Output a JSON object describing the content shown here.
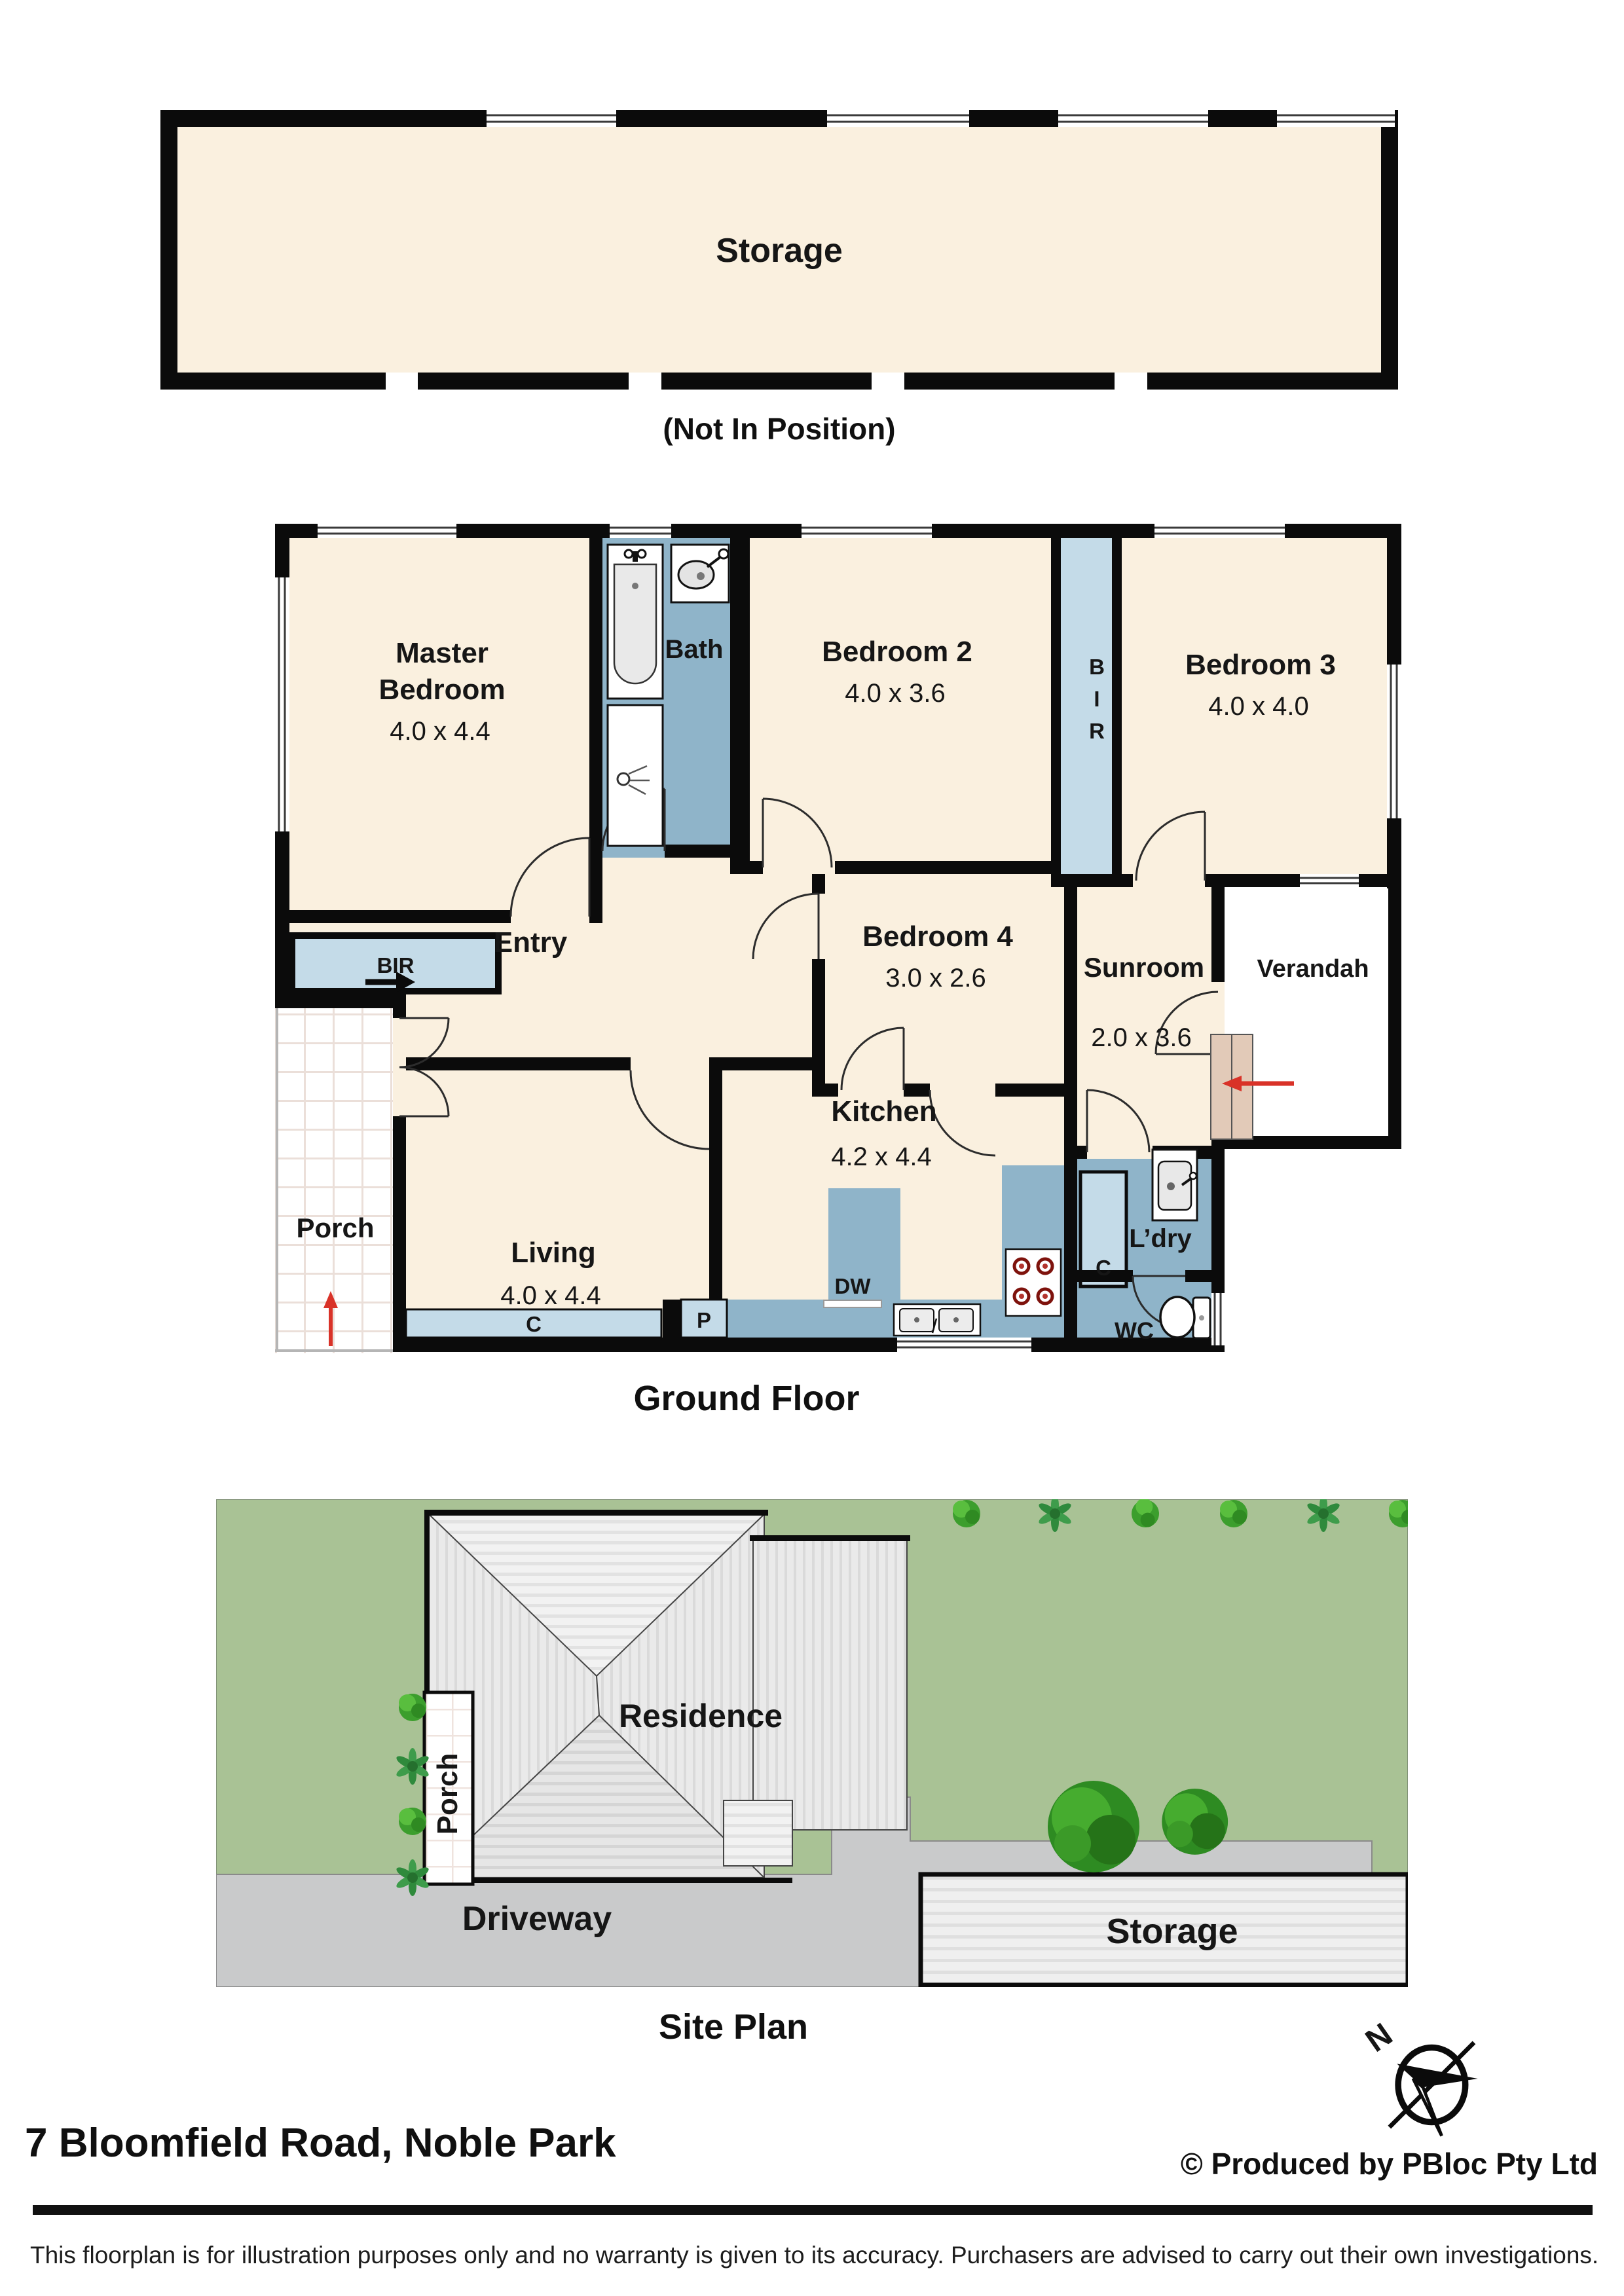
{
  "storage_upper": {
    "label": "Storage",
    "note": "(Not In Position)"
  },
  "ground_floor": {
    "title": "Ground Floor",
    "rooms": {
      "master": {
        "line1": "Master",
        "line2": "Bedroom",
        "dims": "4.0 x 4.4"
      },
      "bath": {
        "name": "Bath"
      },
      "bedroom2": {
        "name": "Bedroom 2",
        "dims": "4.0 x 3.6"
      },
      "bedroom3": {
        "name": "Bedroom 3",
        "dims": "4.0 x 4.0"
      },
      "bedroom4": {
        "name": "Bedroom 4",
        "dims": "3.0 x 2.6"
      },
      "entry": {
        "name": "Entry"
      },
      "sunroom": {
        "name": "Sunroom",
        "dims": "2.0 x 3.6"
      },
      "verandah": {
        "name": "Verandah"
      },
      "porch": {
        "name": "Porch"
      },
      "kitchen": {
        "name": "Kitchen",
        "dims": "4.2 x 4.4"
      },
      "living": {
        "name": "Living",
        "dims": "4.0 x 4.4"
      },
      "laundry": {
        "name": "L’dry"
      },
      "wc": {
        "name": "WC"
      }
    },
    "closets": {
      "bir_master": "BIR",
      "bir_hall": "BIR",
      "cupboard_living": "C",
      "pantry": "P",
      "dishwasher": "DW",
      "cupboard_laundry": "C"
    }
  },
  "site_plan": {
    "title": "Site Plan",
    "residence": "Residence",
    "porch": "Porch",
    "driveway": "Driveway",
    "storage": "Storage"
  },
  "footer": {
    "address": "7 Bloomfield Road, Noble Park",
    "credit": "© Produced by PBloc Pty Ltd",
    "compass_north": "N"
  },
  "disclaimer": "This floorplan is for illustration purposes only and no warranty is given to its accuracy. Purchasers are advised to carry out their own investigations.",
  "colors": {
    "room_cream": "#FAF0DF",
    "wet_blue": "#8FB4C9",
    "closet_blue": "#C4DBE8",
    "wall": "#0B0B0B",
    "grass": "#A9C295",
    "driveway": "#C9CACB",
    "roof": "#ECECEC",
    "storage_fill": "#EFEFEF",
    "steps_tan": "#E2CAB8",
    "arrow_red": "#D93228"
  }
}
